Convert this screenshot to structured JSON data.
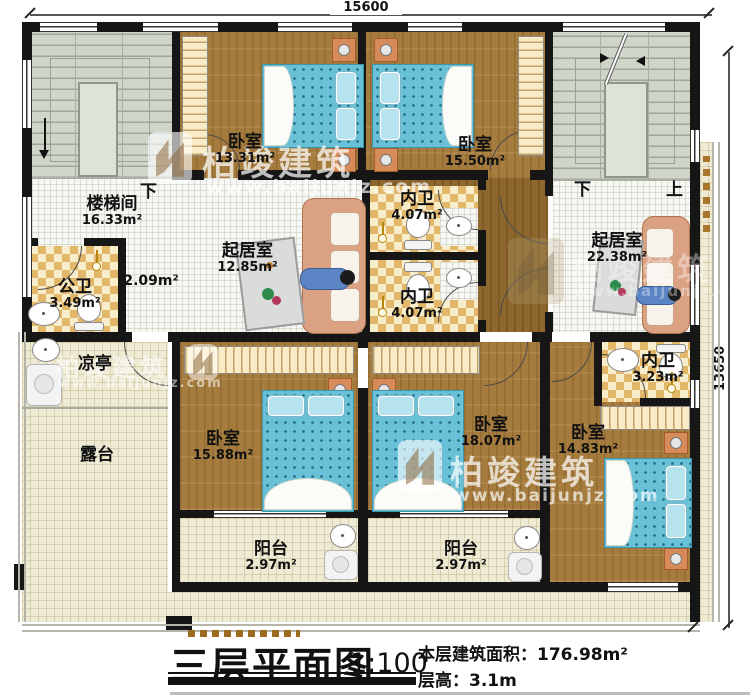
{
  "dims": {
    "width": "15600",
    "height": "13650"
  },
  "title": {
    "name": "三层平面图",
    "scale": "1:100",
    "area": "本层建筑面积：176.98m²",
    "floor_height": "层高：3.1m"
  },
  "stairs": {
    "left_down": "下",
    "right_down": "下",
    "right_up": "上"
  },
  "watermark": {
    "brand": "柏竣建筑",
    "url": "www.baijunjz.com"
  },
  "rooms": {
    "bedroom_tl": {
      "label": "卧室",
      "area": "13.31m²"
    },
    "bedroom_tr": {
      "label": "卧室",
      "area": "15.50m²"
    },
    "stair_hall": {
      "label": "楼梯间",
      "area": "16.33m²"
    },
    "public_bath": {
      "label": "公卫",
      "area": "3.49m²"
    },
    "hall": {
      "area": "2.09m²"
    },
    "living_left": {
      "label": "起居室",
      "area": "12.85m²"
    },
    "bath_up": {
      "label": "内卫",
      "area": "4.07m²"
    },
    "bath_low": {
      "label": "内卫",
      "area": "4.07m²"
    },
    "living_right": {
      "label": "起居室",
      "area": "22.38m²"
    },
    "pavilion": {
      "label": "凉亭"
    },
    "terrace": {
      "label": "露台"
    },
    "bedroom_bl": {
      "label": "卧室",
      "area": "15.88m²"
    },
    "bedroom_bm": {
      "label": "卧室",
      "area": "18.07m²"
    },
    "bedroom_br": {
      "label": "卧室",
      "area": "14.83m²"
    },
    "bath_right": {
      "label": "内卫",
      "area": "3.23m²"
    },
    "balcony_left": {
      "label": "阳台",
      "area": "2.97m²"
    },
    "balcony_right": {
      "label": "阳台",
      "area": "2.97m²"
    }
  }
}
